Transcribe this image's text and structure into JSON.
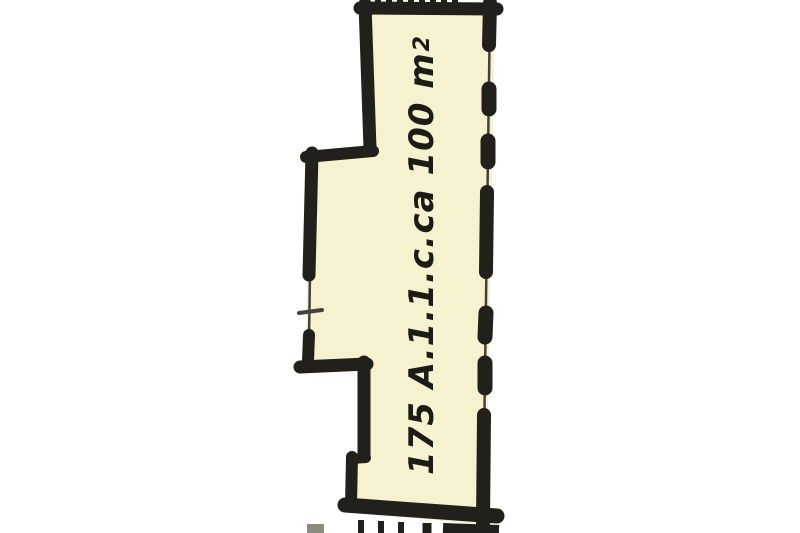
{
  "floorplan": {
    "room_label": "175 A.1.1.c.",
    "area_text": "ca 100 m",
    "area_superscript": "2",
    "colors": {
      "background": "#ffffff",
      "room_fill": "#f6f1ce",
      "wall": "#22201b",
      "thin_line": "#45423c",
      "faint_mark": "#8d8a82",
      "text": "#1d1b16"
    }
  }
}
